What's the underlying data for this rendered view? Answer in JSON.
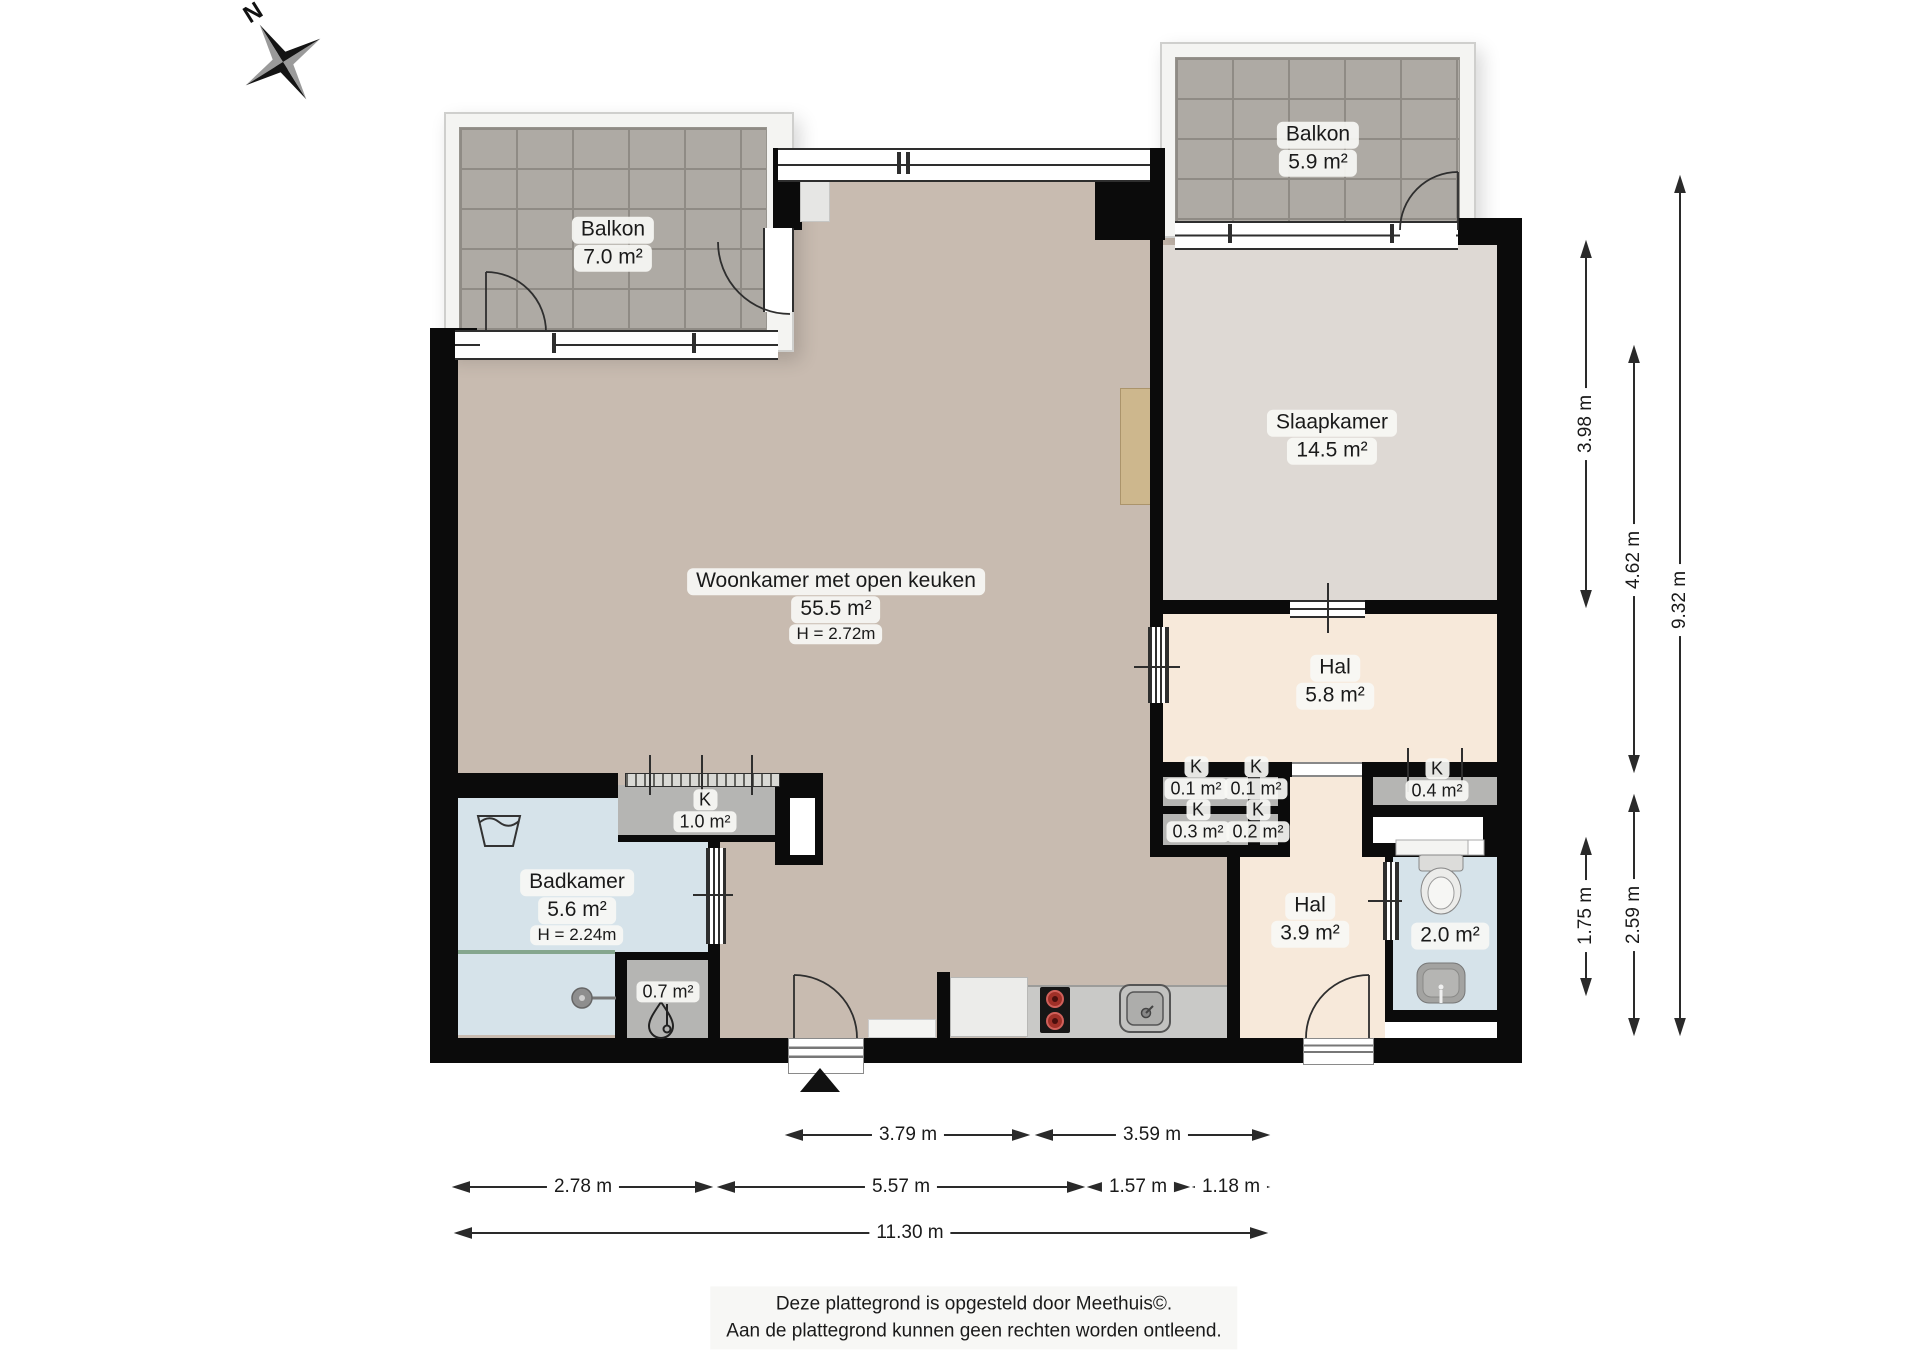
{
  "compass": {
    "label": "N"
  },
  "rooms": {
    "balkon_left": {
      "name": "Balkon",
      "area": "7.0 m²"
    },
    "balkon_right": {
      "name": "Balkon",
      "area": "5.9 m²"
    },
    "woonkamer": {
      "name": "Woonkamer met open keuken",
      "area": "55.5 m²",
      "ceiling": "H = 2.72m"
    },
    "slaapkamer": {
      "name": "Slaapkamer",
      "area": "14.5 m²"
    },
    "hal_boven": {
      "name": "Hal",
      "area": "5.8 m²"
    },
    "hal_beneden": {
      "name": "Hal",
      "area": "3.9 m²"
    },
    "badkamer": {
      "name": "Badkamer",
      "area": "5.6 m²",
      "ceiling": "H = 2.24m"
    },
    "kast_keuken": {
      "name": "K",
      "area": "1.0 m²"
    },
    "kast_a": {
      "name": "K",
      "area": "0.1 m²"
    },
    "kast_b": {
      "name": "K",
      "area": "0.1 m²"
    },
    "kast_c": {
      "name": "K",
      "area": "0.4 m²"
    },
    "kast_d": {
      "name": "K",
      "area": "0.3 m²"
    },
    "kast_e": {
      "name": "K",
      "area": "0.2 m²"
    },
    "toilet": {
      "area": "2.0 m²"
    },
    "techniek": {
      "area": "0.7 m²"
    }
  },
  "dimensions": {
    "right": [
      {
        "label": "3.98 m"
      },
      {
        "label": "4.62 m"
      },
      {
        "label": "9.32 m"
      },
      {
        "label": "1.75 m"
      },
      {
        "label": "2.59 m"
      }
    ],
    "bottom": [
      {
        "label": "3.79 m"
      },
      {
        "label": "3.59 m"
      },
      {
        "label": "2.78 m"
      },
      {
        "label": "5.57 m"
      },
      {
        "label": "1.57 m"
      },
      {
        "label": "1.18 m"
      },
      {
        "label": "11.30 m"
      }
    ]
  },
  "footer": {
    "line1": "Deze plattegrond is opgesteld door Meethuis©.",
    "line2": "Aan de plattegrond kunnen geen rechten worden ontleend."
  },
  "colors": {
    "wall": "#0b0b0b",
    "living_floor": "#c8bbb0",
    "bedroom_floor": "#ded9d4",
    "hall_floor": "#f7e9da",
    "bath_floor": "#d6e3ea",
    "closet_floor": "#b5b5b3",
    "balcony_tile": "#aeaaa4",
    "counter": "#c9c9c7",
    "stove_burner": "#a03028",
    "wood_accent": "#cdb78d"
  }
}
